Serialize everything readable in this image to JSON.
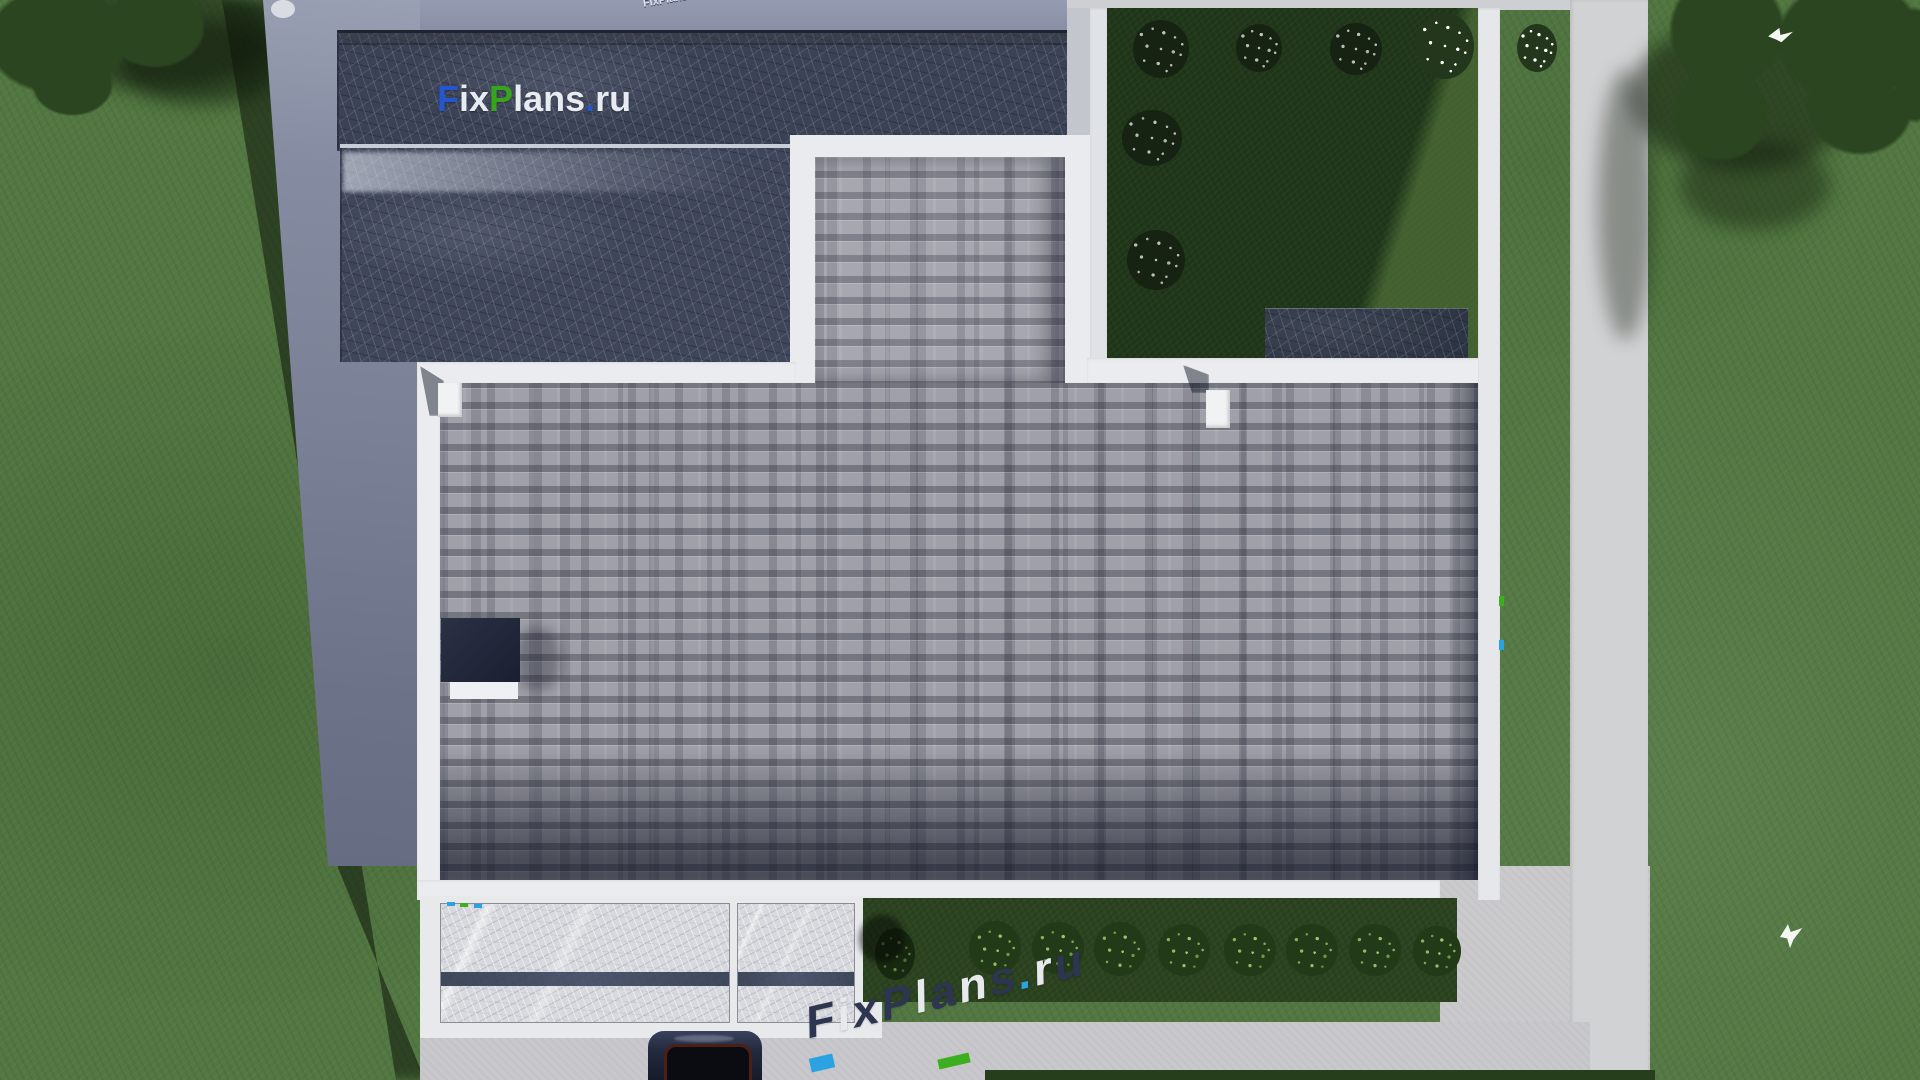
{
  "site": {
    "brand": "FixPlans.ru"
  },
  "watermarks": {
    "roof_logo": {
      "text": "FixPlans.ru",
      "letters": [
        {
          "ch": "F",
          "color": "#2456d2"
        },
        {
          "ch": "i",
          "color": "#e9ebf2"
        },
        {
          "ch": "x",
          "color": "#e9ebf2"
        },
        {
          "ch": "P",
          "color": "#37a41d"
        },
        {
          "ch": "l",
          "color": "#e9ebf2"
        },
        {
          "ch": "a",
          "color": "#e9ebf2"
        },
        {
          "ch": "n",
          "color": "#e9ebf2"
        },
        {
          "ch": "s",
          "color": "#e9ebf2"
        },
        {
          "ch": ".",
          "color": "#2456d2"
        },
        {
          "ch": "r",
          "color": "#e9ebf2"
        },
        {
          "ch": "u",
          "color": "#e9ebf2"
        }
      ]
    },
    "driveway": {
      "text": "FixPlans.ru",
      "letters": [
        {
          "ch": "F",
          "color": "#2d3550"
        },
        {
          "ch": "i",
          "color": "#e8e9ec"
        },
        {
          "ch": "x",
          "color": "#2d3550"
        },
        {
          "ch": "P",
          "color": "#2d3550"
        },
        {
          "ch": "l",
          "color": "#e8e9ec"
        },
        {
          "ch": "a",
          "color": "#2d3550"
        },
        {
          "ch": "n",
          "color": "#e8e9ec"
        },
        {
          "ch": "s",
          "color": "#2d3550"
        },
        {
          "ch": ".",
          "color": "#2ba3e2"
        },
        {
          "ch": "r",
          "color": "#e8e9ec"
        },
        {
          "ch": "u",
          "color": "#2d3550"
        }
      ]
    },
    "top_edge": {
      "text": "FixPlans.ru"
    }
  },
  "palette": {
    "grass": "#527741",
    "grass_shadow": "#1d3014",
    "courtyard_lawn": "#20371a",
    "concrete_pad": "#7a8095",
    "walkway": "#d1d2d4",
    "driveway": "#c8c8cc",
    "parapet_white": "#eaecef",
    "roof_shingle": "#9fa0a8",
    "roof_dark_marble": "#3b4256",
    "terrace_marble": "#d8d9de",
    "accent_blue": "#2456d2",
    "accent_green": "#37a41d",
    "accent_cyan": "#2ba3e2",
    "navy": "#2d3550",
    "car_body": "#232a3e"
  },
  "scene": {
    "description": "Top-down aerial 3D render of a modern flat-roof house plot",
    "objects": [
      "main shingle flat roof with white parapet",
      "two dark marble-textured roof sections (north wing)",
      "roof-access tower with white frame",
      "courtyard lawn with white flowering shrubs",
      "dark pergola slab in courtyard",
      "marble terrace canopy at south side",
      "hedge of 9 round bushes on grass strip",
      "dark car on driveway",
      "trees at top-left and top-right corners",
      "two white birds in flight",
      "long building shadow cast to the west"
    ],
    "counts": {
      "white_flower_shrubs": 7,
      "hedge_bushes": 9,
      "birds": 2,
      "cars": 1
    }
  }
}
